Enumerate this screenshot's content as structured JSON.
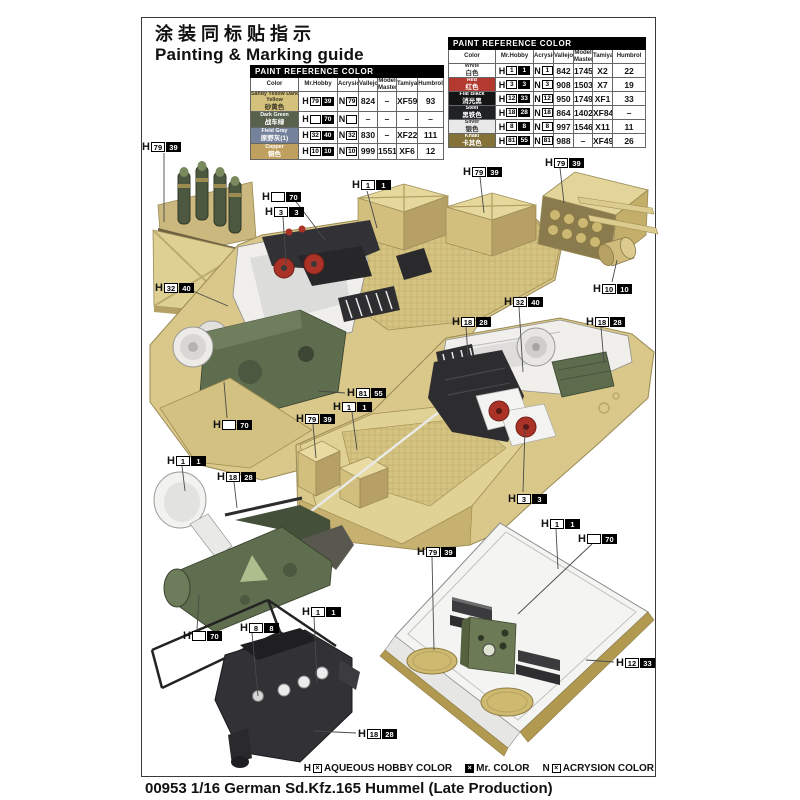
{
  "header": {
    "title_zh": "涂装同标贴指示",
    "title_en": "Painting & Marking guide"
  },
  "prefixes": {
    "h": "H",
    "n": "N"
  },
  "paint_table": {
    "title": "PAINT  REFERENCE COLOR",
    "columns": [
      "Color",
      "Mr.Hobby",
      "Acrysion",
      "Vallejo",
      "Model Master",
      "Tamiya",
      "Humbrol"
    ],
    "left_rows": [
      {
        "name_en": "Sandy Yellow Dark Yellow",
        "name_zh": "砂黄色",
        "swatch": "#d3c17c",
        "mh_w": "79",
        "mh_b": "39",
        "ac": "79",
        "vallejo": "824",
        "model_master": "–",
        "tamiya": "XF59",
        "humbrol": "93"
      },
      {
        "name_en": "Dark Green",
        "name_zh": "战车绿",
        "swatch": "#57614c",
        "mh_w": "",
        "mh_b": "70",
        "ac": "",
        "vallejo": "–",
        "model_master": "–",
        "tamiya": "–",
        "humbrol": "–"
      },
      {
        "name_en": "Field Gray",
        "name_zh": "原野灰(1)",
        "swatch": "#75829b",
        "mh_w": "32",
        "mh_b": "40",
        "ac": "32",
        "vallejo": "830",
        "model_master": "–",
        "tamiya": "XF22",
        "humbrol": "111"
      },
      {
        "name_en": "Copper",
        "name_zh": "铜色",
        "swatch": "#c0a05e",
        "mh_w": "10",
        "mh_b": "10",
        "ac": "10",
        "vallejo": "999",
        "model_master": "1551",
        "tamiya": "XF6",
        "humbrol": "12"
      }
    ],
    "right_rows": [
      {
        "name_en": "White",
        "name_zh": "白色",
        "swatch": "#ffffff",
        "mh_w": "1",
        "mh_b": "1",
        "ac": "1",
        "vallejo": "842",
        "model_master": "1745",
        "tamiya": "X2",
        "humbrol": "22"
      },
      {
        "name_en": "Red",
        "name_zh": "红色",
        "swatch": "#b23a31",
        "mh_w": "3",
        "mh_b": "3",
        "ac": "3",
        "vallejo": "908",
        "model_master": "1503",
        "tamiya": "X7",
        "humbrol": "19"
      },
      {
        "name_en": "Flat Black",
        "name_zh": "消光黑",
        "swatch": "#141414",
        "mh_w": "12",
        "mh_b": "33",
        "ac": "12",
        "vallejo": "950",
        "model_master": "1749",
        "tamiya": "XF1",
        "humbrol": "33"
      },
      {
        "name_en": "Steel",
        "name_zh": "黑铁色",
        "swatch": "#202226",
        "mh_w": "18",
        "mh_b": "28",
        "ac": "18",
        "vallejo": "864",
        "model_master": "1402",
        "tamiya": "XF84",
        "humbrol": "–"
      },
      {
        "name_en": "Silver",
        "name_zh": "银色",
        "swatch": "#e8e8e8",
        "mh_w": "8",
        "mh_b": "8",
        "ac": "8",
        "vallejo": "997",
        "model_master": "1546",
        "tamiya": "X11",
        "humbrol": "11"
      },
      {
        "name_en": "Khaki",
        "name_zh": "卡其色",
        "swatch": "#857239",
        "mh_w": "81",
        "mh_b": "55",
        "ac": "81",
        "vallejo": "988",
        "model_master": "–",
        "tamiya": "XF49",
        "humbrol": "26"
      }
    ]
  },
  "callouts": [
    {
      "w": "79",
      "b": "39"
    },
    {
      "w": "1",
      "b": "1"
    },
    {
      "w": "",
      "b": "70"
    },
    {
      "w": "3",
      "b": "3"
    },
    {
      "w": "79",
      "b": "39"
    },
    {
      "w": "79",
      "b": "39"
    },
    {
      "w": "10",
      "b": "10"
    },
    {
      "w": "32",
      "b": "40"
    },
    {
      "w": "32",
      "b": "40"
    },
    {
      "w": "18",
      "b": "28"
    },
    {
      "w": "18",
      "b": "28"
    },
    {
      "w": "81",
      "b": "55"
    },
    {
      "w": "1",
      "b": "1"
    },
    {
      "w": "79",
      "b": "39"
    },
    {
      "w": "",
      "b": "70"
    },
    {
      "w": "3",
      "b": "3"
    },
    {
      "w": "1",
      "b": "1"
    },
    {
      "w": "18",
      "b": "28"
    },
    {
      "w": "",
      "b": "70"
    },
    {
      "w": "8",
      "b": "8"
    },
    {
      "w": "1",
      "b": "1"
    },
    {
      "w": "18",
      "b": "28"
    },
    {
      "w": "79",
      "b": "39"
    },
    {
      "w": "1",
      "b": "1"
    },
    {
      "w": "",
      "b": "70"
    },
    {
      "w": "12",
      "b": "33"
    }
  ],
  "legend": {
    "aqueous_prefix": "H",
    "aqueous_label": "AQUEOUS HOBBY COLOR",
    "mr_label": "Mr. COLOR",
    "acrysion_prefix": "N",
    "acrysion_label": "ACRYSION COLOR",
    "box_glyph": "×"
  },
  "footer": {
    "title": "00953 1/16  German Sd.Kfz.165 Hummel (Late Production)"
  },
  "colors": {
    "hull_tan": "#d9c88a",
    "deck_tan": "#dbcb8e",
    "interior_white": "#f0efec",
    "engine_dark": "#2d2d2f",
    "equipment_green": "#5e6d4d",
    "seat_red": "#aa3227",
    "shell_green": "#4c5840",
    "table_header_bg": "#000000"
  }
}
